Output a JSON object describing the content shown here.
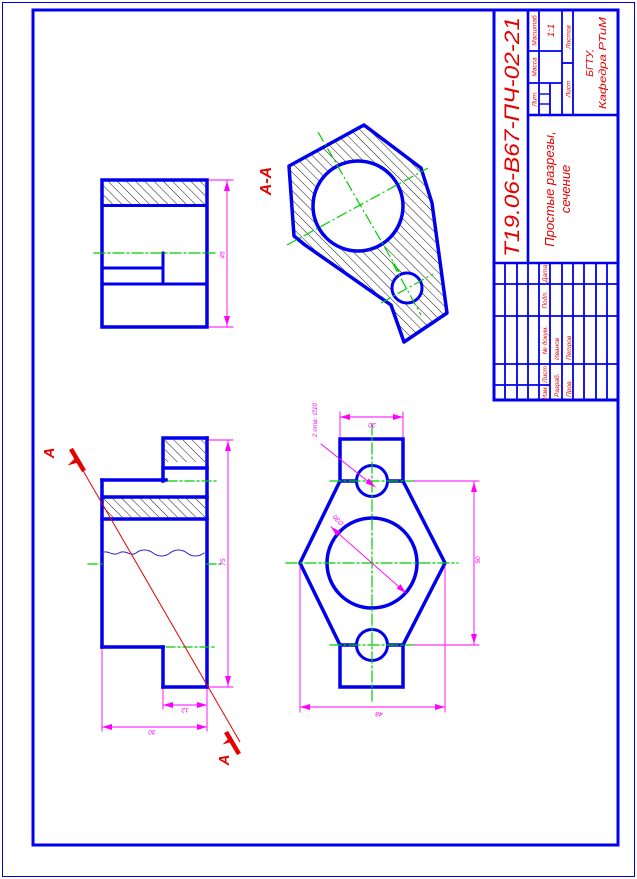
{
  "colors": {
    "outline_blue": "#0000ee",
    "dimension_magenta": "#ff00ff",
    "centerline_green": "#00cc00",
    "annotation_red": "#e60000",
    "hatch_black": "#000000"
  },
  "views": {
    "section_label": "А-А",
    "cut_letter_top": "А",
    "cut_letter_bottom": "А"
  },
  "dimensions": {
    "front_height": "45",
    "side_height": "75",
    "side_step_width": "12",
    "side_width": "30",
    "hex_tab_width": "20",
    "hex_between_flats": "50",
    "hex_across_corners": "48",
    "bore_diameter": "∅30",
    "holes_note": "2 отв. ∅10"
  },
  "title_block": {
    "doc_number": "Т19.06-В67-ПЧ-02-21",
    "title_line1": "Простые разрезы,",
    "title_line2": "сечение",
    "scale_value": "1:1",
    "lit_label": "Лит.",
    "mass_label": "Масса",
    "scale_label": "Масштаб",
    "sheet_label": "Лист",
    "sheets_label": "Листов",
    "rev": {
      "izm": "Изм.",
      "list": "Лист",
      "doc": "№ докум.",
      "podp": "Подп.",
      "data": "Дата"
    },
    "developed_label": "Разраб.",
    "developed_name": "Иванов",
    "checked_label": "Пров.",
    "checked_name": "Петров",
    "org_line1": "БГТУ,",
    "org_line2": "Кафедра РТиМ"
  }
}
